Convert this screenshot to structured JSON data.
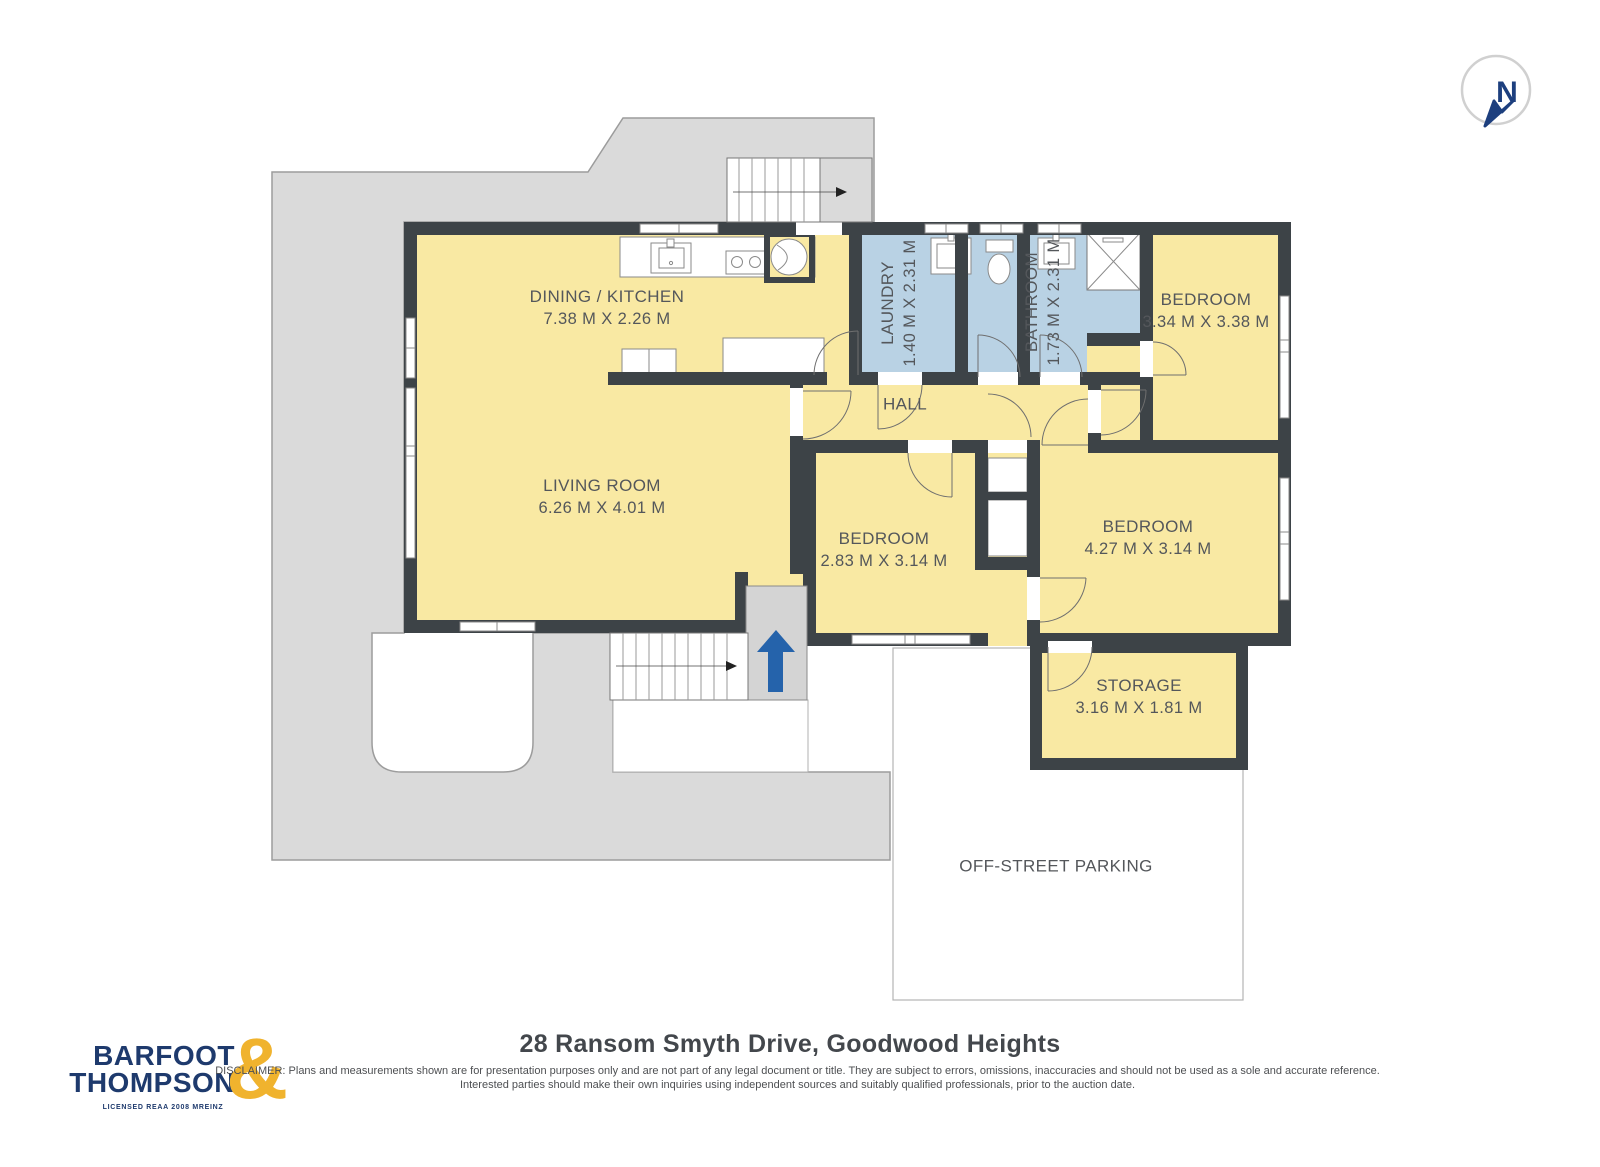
{
  "compass": {
    "label": "N"
  },
  "rooms": [
    {
      "name": "DINING / KITCHEN",
      "dims": "7.38 M X 2.26 M"
    },
    {
      "name": "LIVING ROOM",
      "dims": "6.26 M X 4.01 M"
    },
    {
      "name": "LAUNDRY",
      "dims": "1.40 M X 2.31 M"
    },
    {
      "name": "BATHROOM",
      "dims": "1.73 M X 2.31 M"
    },
    {
      "name": "BEDROOM",
      "dims": "3.34 M X 3.38 M"
    },
    {
      "name": "HALL",
      "dims": ""
    },
    {
      "name": "BEDROOM",
      "dims": "2.83 M X 3.14 M"
    },
    {
      "name": "BEDROOM",
      "dims": "4.27 M X 3.14 M"
    },
    {
      "name": "STORAGE",
      "dims": "3.16 M X 1.81 M"
    },
    {
      "name": "OFF-STREET PARKING",
      "dims": ""
    }
  ],
  "footer": {
    "logo_line1": "BARFOOT",
    "logo_line2": "THOMPSON",
    "logo_ampersand": "&",
    "logo_tagline": "LICENSED REAA 2008 MREINZ",
    "title": "28 Ransom Smyth Drive, Goodwood Heights",
    "disclaimer": "DISCLAIMER: Plans and measurements shown are for presentation purposes only and are not part of any legal document or title. They are subject to errors, omissions, inaccuracies and should not be used as a sole and accurate reference. Interested parties should make their own inquiries using independent sources and suitably qualified professionals, prior to the auction date."
  },
  "colors": {
    "room_yellow": "#f9e9a3",
    "wet_room_blue": "#b9d2e4",
    "wall_dark": "#3d4347",
    "driveway_gray": "#dadada",
    "entry_arrow_blue": "#2563ab",
    "logo_navy": "#1e3a6d",
    "logo_gold": "#f0b32e"
  }
}
